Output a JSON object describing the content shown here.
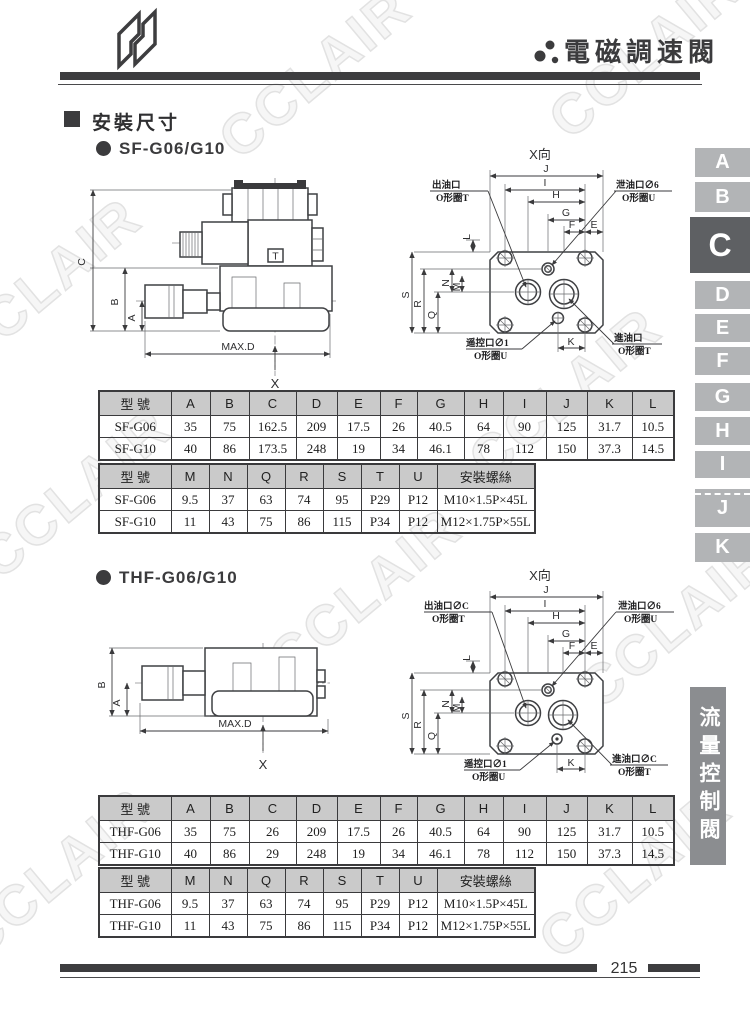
{
  "header": {
    "title": "電磁調速閥"
  },
  "watermark": {
    "text": "CCLAIR"
  },
  "section": {
    "title": "安裝尺寸"
  },
  "sf": {
    "title": "SF-G06/G10"
  },
  "thf": {
    "title": "THF-G06/G10"
  },
  "dims": {
    "view_title": "X向",
    "side": {
      "c": "C",
      "b": "B",
      "a": "A",
      "max_d": "MAX.D",
      "x": "X",
      "t": "T"
    },
    "front_top": [
      "J",
      "I",
      "H",
      "G",
      "F",
      "E"
    ],
    "front_left": [
      "S",
      "R",
      "Q",
      "N",
      "M",
      "L"
    ],
    "front_bottom": "K"
  },
  "callouts": {
    "sf": {
      "outlet_l1": "出油口",
      "outlet_l2": "O形圈T",
      "drain_l1": "泄油口∅6",
      "drain_l2": "O形圈U",
      "remote_l1": "遥控口∅1",
      "remote_l2": "O形圈U",
      "inlet_l1": "進油口",
      "inlet_l2": "O形圈T"
    },
    "thf": {
      "outlet_l1": "出油口∅C",
      "outlet_l2": "O形圈T",
      "drain_l1": "泄油口∅6",
      "drain_l2": "O形圈U",
      "remote_l1": "遥控口∅1",
      "remote_l2": "O形圈U",
      "inlet_l1": "進油口∅C",
      "inlet_l2": "O形圈T"
    }
  },
  "tables": {
    "sf1": {
      "headers": [
        "型 號",
        "A",
        "B",
        "C",
        "D",
        "E",
        "F",
        "G",
        "H",
        "I",
        "J",
        "K",
        "L"
      ],
      "rows": [
        [
          "SF-G06",
          "35",
          "75",
          "162.5",
          "209",
          "17.5",
          "26",
          "40.5",
          "64",
          "90",
          "125",
          "31.7",
          "10.5"
        ],
        [
          "SF-G10",
          "40",
          "86",
          "173.5",
          "248",
          "19",
          "34",
          "46.1",
          "78",
          "112",
          "150",
          "37.3",
          "14.5"
        ]
      ]
    },
    "sf2": {
      "headers": [
        "型 號",
        "M",
        "N",
        "Q",
        "R",
        "S",
        "T",
        "U",
        "安裝螺絲"
      ],
      "rows": [
        [
          "SF-G06",
          "9.5",
          "37",
          "63",
          "74",
          "95",
          "P29",
          "P12",
          "M10×1.5P×45L"
        ],
        [
          "SF-G10",
          "11",
          "43",
          "75",
          "86",
          "115",
          "P34",
          "P12",
          "M12×1.75P×55L"
        ]
      ]
    },
    "thf1": {
      "headers": [
        "型 號",
        "A",
        "B",
        "C",
        "D",
        "E",
        "F",
        "G",
        "H",
        "I",
        "J",
        "K",
        "L"
      ],
      "rows": [
        [
          "THF-G06",
          "35",
          "75",
          "26",
          "209",
          "17.5",
          "26",
          "40.5",
          "64",
          "90",
          "125",
          "31.7",
          "10.5"
        ],
        [
          "THF-G10",
          "40",
          "86",
          "29",
          "248",
          "19",
          "34",
          "46.1",
          "78",
          "112",
          "150",
          "37.3",
          "14.5"
        ]
      ]
    },
    "thf2": {
      "headers": [
        "型 號",
        "M",
        "N",
        "Q",
        "R",
        "S",
        "T",
        "U",
        "安裝螺絲"
      ],
      "rows": [
        [
          "THF-G06",
          "9.5",
          "37",
          "63",
          "74",
          "95",
          "P29",
          "P12",
          "M10×1.5P×45L"
        ],
        [
          "THF-G10",
          "11",
          "43",
          "75",
          "86",
          "115",
          "P34",
          "P12",
          "M12×1.75P×55L"
        ]
      ]
    }
  },
  "side_tabs": {
    "items": [
      "A",
      "B",
      "C",
      "D",
      "E",
      "F",
      "G",
      "H",
      "I",
      "J",
      "K"
    ],
    "active": "C"
  },
  "category": {
    "label": "流量控制閥"
  },
  "footer": {
    "page_number": "215"
  },
  "colors": {
    "accent": "#3d3d3f",
    "table_header_bg": "#cacaca",
    "tab_bg": "#b2b4b6",
    "tab_active_bg": "#5e6063",
    "category_bg": "#8b8d90",
    "watermark": "#e2e2e2"
  }
}
